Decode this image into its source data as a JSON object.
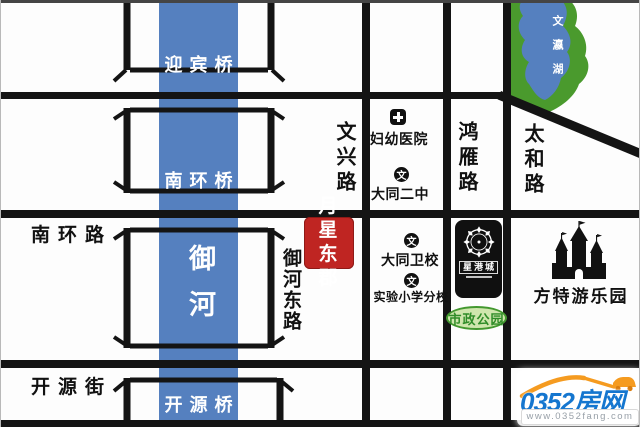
{
  "river": {
    "label": "御河"
  },
  "lake": {
    "label": "文瀛湖"
  },
  "bridges": {
    "yingbin": {
      "label": "迎宾桥"
    },
    "nanhuan": {
      "label": "南环桥"
    },
    "kaiyuan": {
      "label": "开源桥"
    }
  },
  "roads": {
    "nanhuan_road": {
      "label": "南环路"
    },
    "kaiyuan_street": {
      "label": "开源街"
    },
    "yuhe_east_road": {
      "label": "御河东路"
    },
    "wenxing_road": {
      "label": "文兴路"
    },
    "hongyan_road": {
      "label": "鸿雁路"
    },
    "taihe_road": {
      "label": "太和路"
    }
  },
  "property": {
    "label": "月星东郡",
    "color": "#bf2522"
  },
  "pois": {
    "hospital": {
      "label": "妇幼医院"
    },
    "datong_no2_middle_school": {
      "label": "大同二中",
      "icon_char": "文"
    },
    "datong_health_school": {
      "label": "大同卫校",
      "icon_char": "文"
    },
    "experimental_primary_branch": {
      "label": "实验小学分校",
      "icon_char": "文"
    },
    "municipal_park": {
      "label": "市政公园"
    },
    "star_harbor_mall": {
      "label": "星港城"
    },
    "fantawild_park": {
      "label": "方特游乐园"
    }
  },
  "watermark": {
    "brand": "0352房网",
    "url": "www.0352fang.com"
  },
  "colors": {
    "river_blue": "#5580bf",
    "road_black": "#141414",
    "lake_green": "#4a9a2d",
    "badge_red": "#bf2522",
    "park_green": "#2f8c28",
    "brand_blue": "#1576cf",
    "brand_orange": "#f59b20"
  }
}
